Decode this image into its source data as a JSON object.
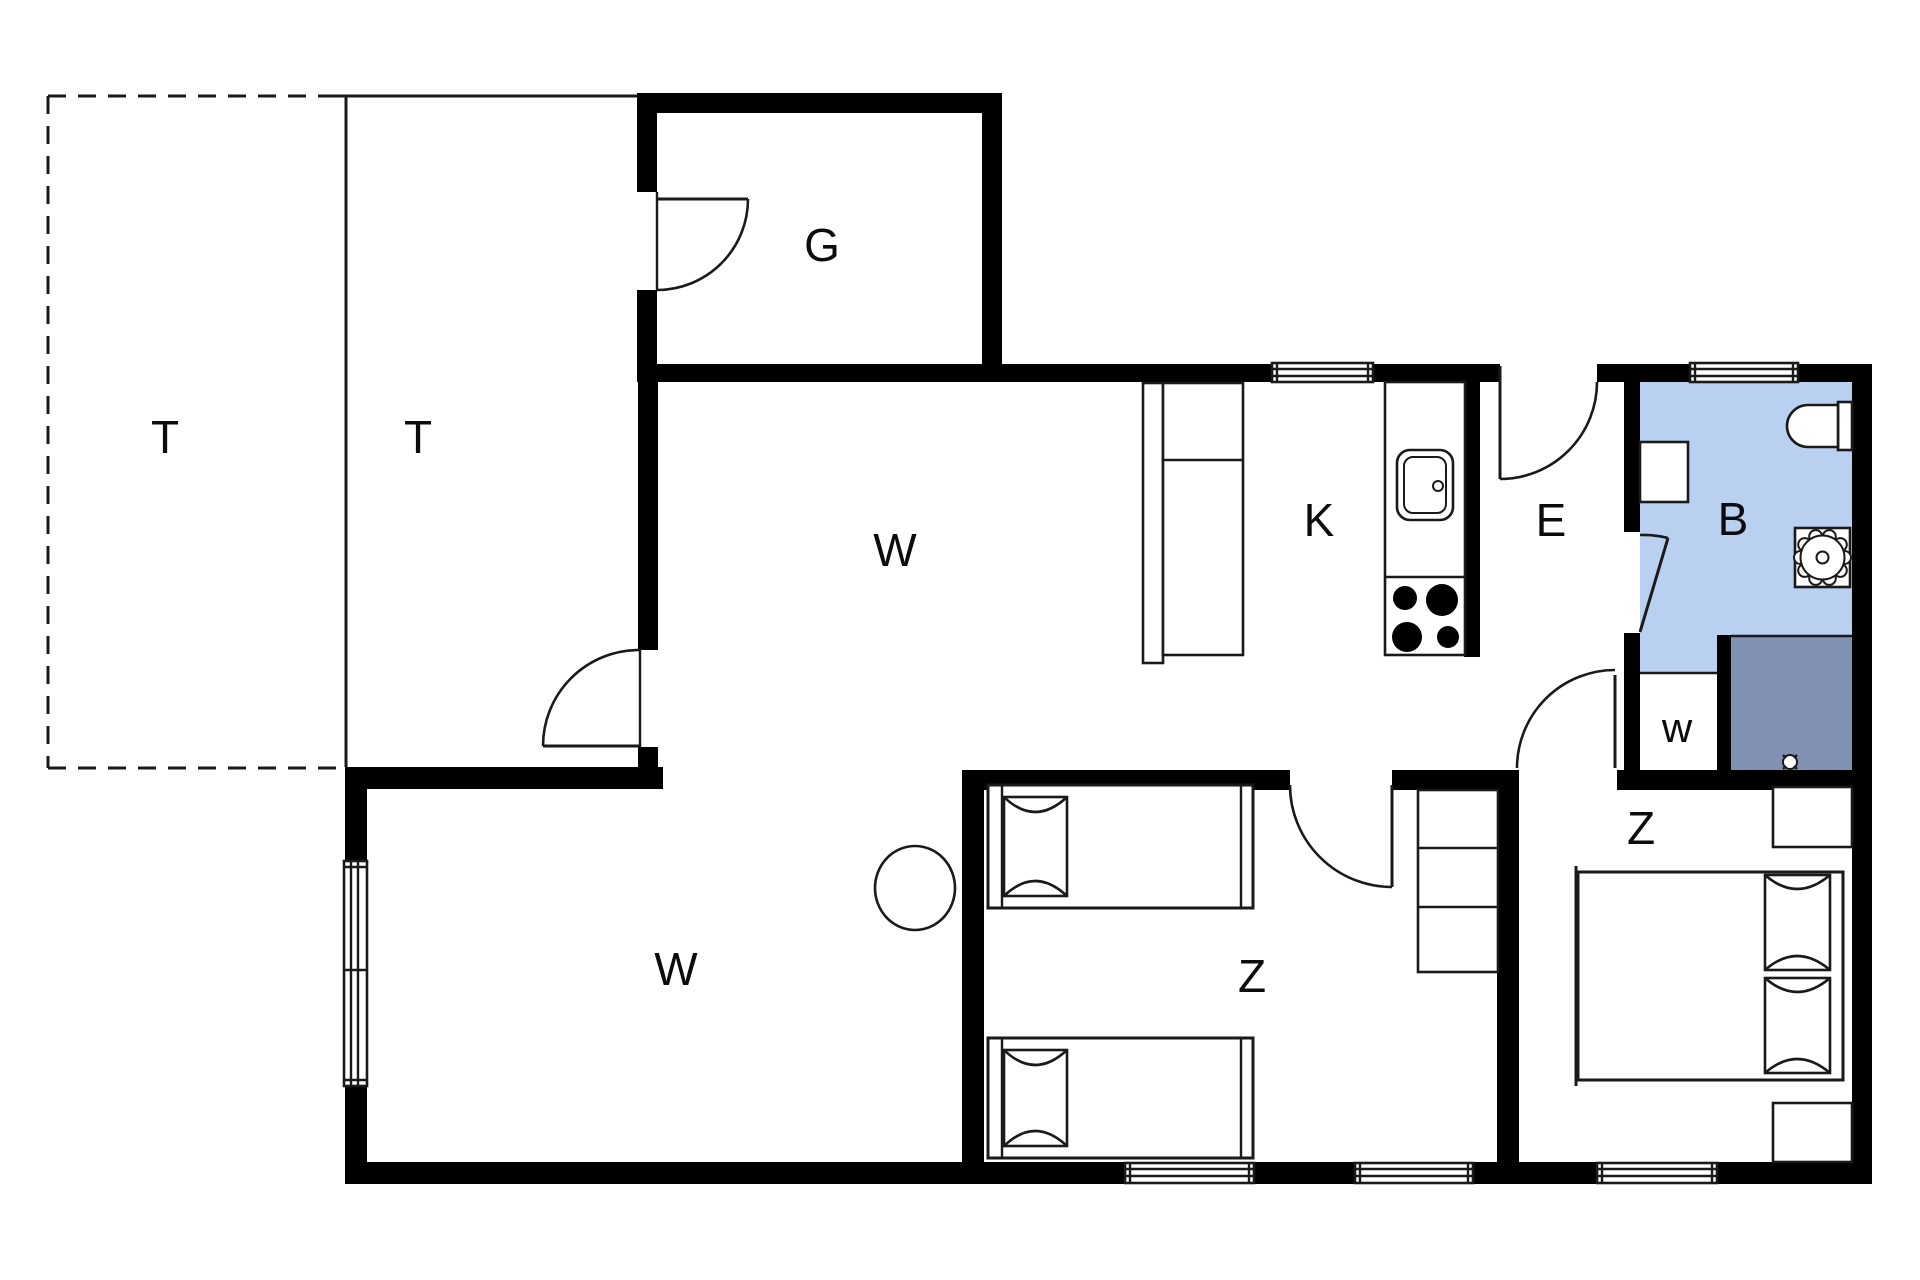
{
  "floorplan": {
    "type": "holiday-home-floor-plan",
    "colors": {
      "wall": "#000000",
      "line": "#1a1a1a",
      "bathroom_fill": "#b9d0f0",
      "shower_fill": "#8091b4",
      "background": "#ffffff"
    },
    "rooms": [
      {
        "id": "terrace-open",
        "label": "T"
      },
      {
        "id": "terrace-covered",
        "label": "T"
      },
      {
        "id": "annex-room",
        "label": "G"
      },
      {
        "id": "living-room-upper",
        "label": "W"
      },
      {
        "id": "kitchen",
        "label": "K"
      },
      {
        "id": "entry",
        "label": "E"
      },
      {
        "id": "bathroom",
        "label": "B"
      },
      {
        "id": "utility-closet",
        "label": "w"
      },
      {
        "id": "living-room-lower",
        "label": "W"
      },
      {
        "id": "bedroom-middle",
        "label": "Z"
      },
      {
        "id": "bedroom-right",
        "label": "Z"
      }
    ],
    "fixtures": [
      "annex-door",
      "terrace-door",
      "entrance-door",
      "bathroom-door",
      "bedroom-middle-door",
      "bedroom-right-door",
      "window-kitchen",
      "window-bathroom",
      "window-bedroom-middle-1",
      "window-bedroom-middle-2",
      "window-bedroom-right",
      "window-living-left",
      "kitchen-counter",
      "kitchen-sink",
      "stove-burners",
      "tall-cabinet",
      "bathroom-cabinet",
      "toilet",
      "washbasin",
      "shower",
      "floor-drain",
      "single-bed-1",
      "single-bed-2",
      "double-bed",
      "dresser",
      "nightstand-1",
      "nightstand-2",
      "round-table"
    ]
  }
}
